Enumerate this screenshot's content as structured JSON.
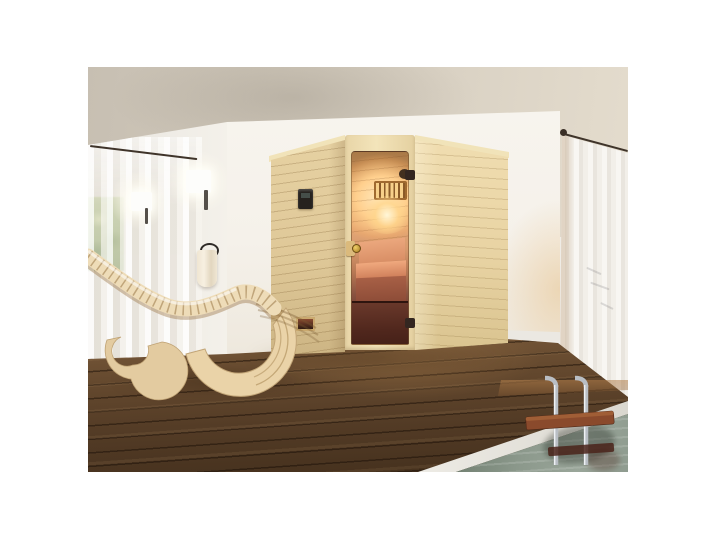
{
  "scene": {
    "title": "3D product photo: indoor wooden sauna cabin with corner entry and bronze glass door, beside a pool with wooden deck and curved slatted lounger",
    "type": "product-photo-render",
    "no_visible_text": true,
    "objects": {
      "ceiling": {
        "label": "plain ceiling",
        "color": "#d3cbbd"
      },
      "left_wall": {
        "label": "white wall with sheer curtains, window greenery, two lit wall lamps and a towel on a black ring",
        "color": "#efece6"
      },
      "window_greenery": {
        "label": "green foliage seen through window behind sheer curtain",
        "color": "#a9bc88"
      },
      "wall_lamps": {
        "label": "two glowing white wall sconces with dark brackets",
        "count": 2,
        "glow_color": "#fffcf0"
      },
      "towel": {
        "label": "beige towel hanging from black wall ring",
        "color": "#efe5d2",
        "ring_color": "#2f2b28"
      },
      "center_wall": {
        "label": "bright white wall block behind the sauna",
        "color": "#f8f5ef"
      },
      "right_curtain": {
        "label": "floor-length white vertical curtain on dark rod with round finial",
        "color": "#f2efe9",
        "rod_color": "#3a2f26"
      },
      "sauna": {
        "label": "light spruce sauna cabin with angled corner entry",
        "wood_color": "#e8d4a6",
        "door": {
          "label": "bronze tinted glass door with gold knob and dark hinges",
          "glass_colors": [
            "#ffe9bd",
            "#d99a6d",
            "#4a251d"
          ],
          "knob_color": "#caa23c"
        },
        "interior": {
          "label": "warm lit interior with slatted wooden lamp shade and benches",
          "lamp_slats": "#f7d08a",
          "bench_color": "#e09a72"
        },
        "control_panel": {
          "label": "black control unit on left wall",
          "color": "#26221e"
        },
        "air_vent": {
          "label": "small air vent near floor of left wall",
          "color": "#8a4a30"
        }
      },
      "lounger": {
        "label": "curved slatted wooden relaxation lounger",
        "color": "#ecd9b4"
      },
      "deck": {
        "label": "dark walnut plank decking",
        "color": "#5d4530"
      },
      "pool": {
        "label": "pool with grey-green water and white coping at lower right",
        "water_color": "#8b988b",
        "coping_color": "#e9e7e1",
        "ladder": {
          "label": "chrome pool ladder with red-brown wooden treads",
          "rail_color": "#b9bec4",
          "tread_color": "#8a4a2c"
        }
      }
    },
    "background_margin_color": "#ffffff"
  }
}
